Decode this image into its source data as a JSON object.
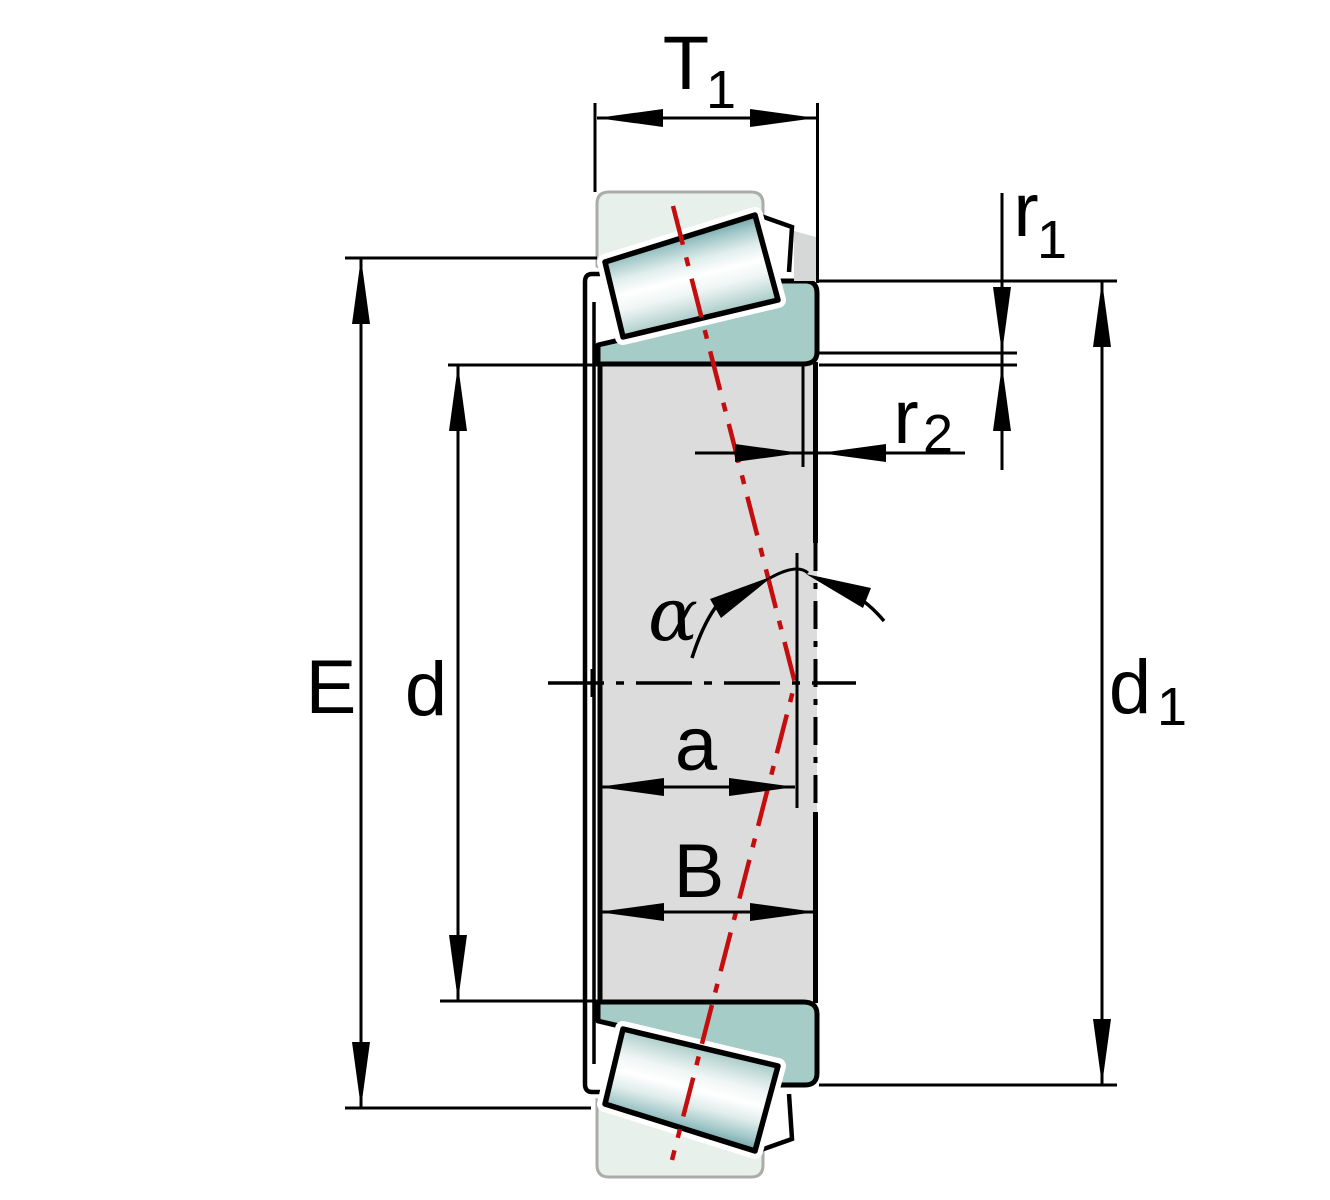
{
  "drawing": {
    "kind": "tapered-roller-bearing-section",
    "dimensions": {
      "t1": {
        "base": "T",
        "sub": "1"
      },
      "r1": {
        "base": "r",
        "sub": "1"
      },
      "r2": {
        "base": "r",
        "sub": "2"
      },
      "e": {
        "base": "E"
      },
      "d": {
        "base": "d"
      },
      "d1": {
        "base": "d",
        "sub": "1"
      },
      "a": {
        "base": "a"
      },
      "b": {
        "base": "B"
      },
      "alpha": {
        "base": "α"
      }
    },
    "colors": {
      "outline": "#000000",
      "pressure_line_red": "#C40D0D",
      "inner_ring_teal": "#A6CCC8",
      "outer_ring_mint": "#E7F0EB",
      "outer_ring_border": "#A9ACA9",
      "section_gray": "#DBDCDB",
      "sliver_gray": "#D6D8D7"
    }
  }
}
